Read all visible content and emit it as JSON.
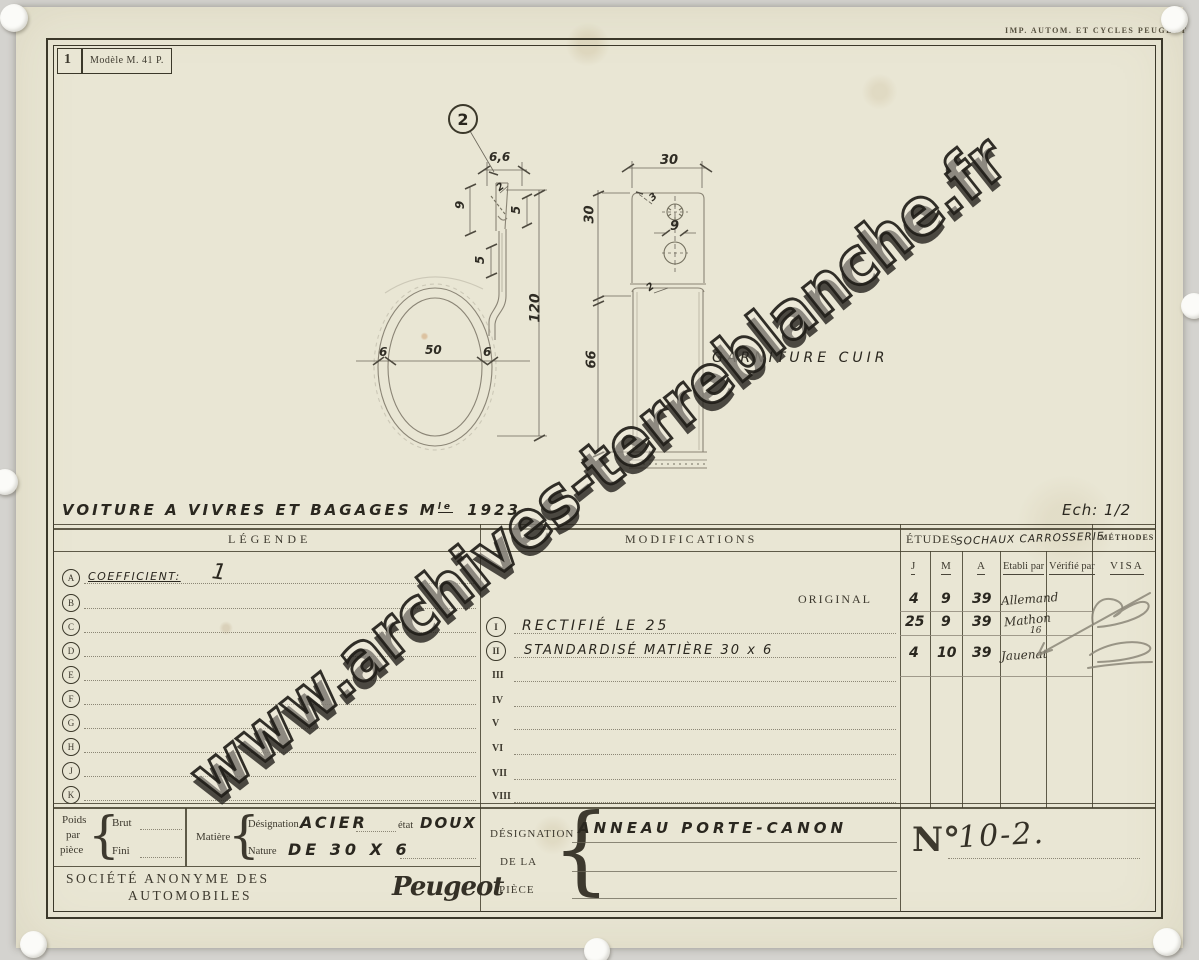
{
  "scan": {
    "imprint": "IMP. AUTOM. ET CYCLES PEUGEOT"
  },
  "form": {
    "sheet_number": "1",
    "model_ref": "Modèle M. 41 P."
  },
  "title": {
    "prefix": "VOITURE A VIVRES ET BAGAGES M",
    "sup": "le",
    "year": "1923",
    "scale": "Ech: 1/2"
  },
  "drawing": {
    "part_ref": "2",
    "note": "GARNITURE CUIR",
    "dims": {
      "top_width": "6,6",
      "tip_height": "9",
      "tip_thk": "2",
      "slot_a": "5",
      "slot_b": "5",
      "overall_height": "120",
      "ring_left": "6",
      "ring_inner": "50",
      "ring_right": "6",
      "strap_width": "30",
      "strap_upper": "30",
      "hole_small": "3",
      "hole_dia": "9",
      "fold_thk": "2",
      "strap_lower": "66"
    }
  },
  "table": {
    "legende": {
      "header": "LÉGENDE",
      "letters": [
        "A",
        "B",
        "C",
        "D",
        "E",
        "F",
        "G",
        "H",
        "J",
        "K"
      ],
      "coefficient_label": "COEFFICIENT:",
      "coefficient_value": "1"
    },
    "modifications": {
      "header": "MODIFICATIONS",
      "original": "ORIGINAL",
      "rows": [
        {
          "numeral": "I",
          "text": "RECTIFIÉ LE 25"
        },
        {
          "numeral": "II",
          "text": "STANDARDISÉ MATIÈRE 30 x 6"
        },
        {
          "numeral": "III",
          "text": ""
        },
        {
          "numeral": "IV",
          "text": ""
        },
        {
          "numeral": "V",
          "text": ""
        },
        {
          "numeral": "VI",
          "text": ""
        },
        {
          "numeral": "VII",
          "text": ""
        },
        {
          "numeral": "VIII",
          "text": ""
        }
      ]
    },
    "etudes": {
      "header": "ÉTUDES",
      "header_hand": "SOCHAUX CARROSSERIE",
      "col_j": "J",
      "col_m": "M",
      "col_a": "A",
      "col_etabli": "Etabli par",
      "col_verifie": "Vérifié par",
      "entries": [
        {
          "j": "4",
          "m": "9",
          "a": "39",
          "name": "Allemand",
          "sub": ""
        },
        {
          "j": "25",
          "m": "9",
          "a": "39",
          "name": "Mathon",
          "sub": "16"
        },
        {
          "j": "4",
          "m": "10",
          "a": "39",
          "name": "Jauenat",
          "sub": ""
        }
      ]
    },
    "methodes": {
      "header": "MÉTHODES",
      "visa": "VISA"
    }
  },
  "cartouche": {
    "poids_label": "Poids",
    "par_label": "par",
    "piece_label": "pièce",
    "brut_label": "Brut",
    "fini_label": "Fini",
    "matiere_label": "Matière",
    "designation_label": "Désignation",
    "designation_value": "ACIER",
    "etat_label": "état",
    "etat_value": "DOUX",
    "nature_label": "Nature",
    "nature_value": "DE 30 X 6",
    "company_line1": "SOCIÉTÉ ANONYME DES",
    "company_line2": "AUTOMOBILES",
    "brand": "Peugeot",
    "piece_box_label1": "DÉSIGNATION",
    "piece_box_label2": "DE LA",
    "piece_box_label3": "PIÈCE",
    "piece_name": "ANNEAU PORTE-CANON",
    "number_label": "N°",
    "number_value": "10-2."
  },
  "watermark": "www.archives-terreblanche.fr",
  "colors": {
    "paper": "#e9e6d4",
    "ink": "#3b382a",
    "pencil": "#8b8678"
  }
}
